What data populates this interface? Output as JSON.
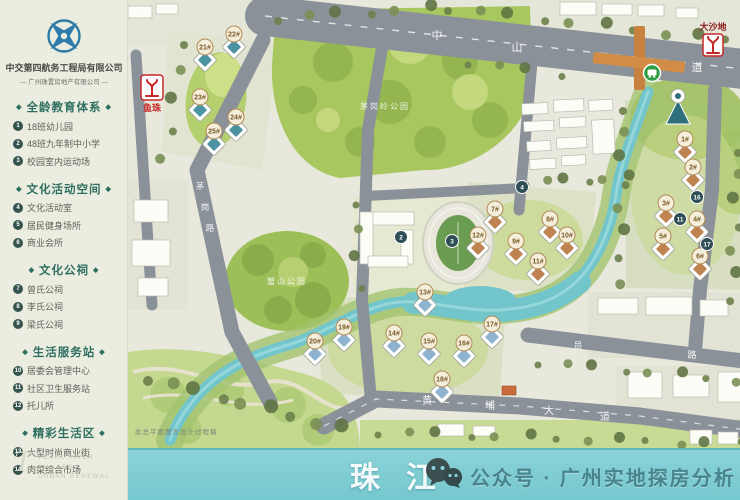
{
  "sidebar": {
    "company_line1": "中交第四航务工程局有限公司",
    "company_line2": "— 广州珠置房地产有限公司 —",
    "sections": [
      {
        "title": "全龄教育体系",
        "items": [
          {
            "num": "1",
            "label": "18班幼儿园"
          },
          {
            "num": "2",
            "label": "48班九年制中小学"
          },
          {
            "num": "3",
            "label": "校园室内运动场"
          }
        ]
      },
      {
        "title": "文化活动空间",
        "items": [
          {
            "num": "4",
            "label": "文化活动室"
          },
          {
            "num": "5",
            "label": "居民健身场所"
          },
          {
            "num": "6",
            "label": "商业会所"
          }
        ]
      },
      {
        "title": "文化公祠",
        "items": [
          {
            "num": "7",
            "label": "曾氏公祠"
          },
          {
            "num": "8",
            "label": "李氏公祠"
          },
          {
            "num": "9",
            "label": "梁氏公祠"
          }
        ]
      },
      {
        "title": "生活服务站",
        "items": [
          {
            "num": "10",
            "label": "居委会管理中心"
          },
          {
            "num": "11",
            "label": "社区卫生服务站"
          },
          {
            "num": "12",
            "label": "托儿所"
          }
        ]
      },
      {
        "title": "精彩生活区",
        "items": [
          {
            "num": "13",
            "label": "大型时尚商业街"
          },
          {
            "num": "14",
            "label": "肉菜综合市场"
          }
        ]
      }
    ],
    "footer_en_1": "PEARL RIVER VILLAGE",
    "footer_en_2": "URBAN RENEWAL"
  },
  "map": {
    "road_labels": [
      {
        "id": "zhongshan-avenue",
        "chars": [
          "中",
          "山",
          "大",
          "道"
        ]
      },
      {
        "id": "maogang-road",
        "chars": [
          "茅",
          "岗",
          "路"
        ]
      },
      {
        "id": "haiyuan-road",
        "chars": [
          "员",
          "路"
        ]
      },
      {
        "id": "huangpu-avenue",
        "chars": [
          "黄",
          "埔",
          "大",
          "道"
        ]
      }
    ],
    "metro_stations": [
      {
        "name": "鱼珠"
      },
      {
        "name": "大沙地"
      }
    ],
    "parks": [
      {
        "name": "茅岗岭公园"
      },
      {
        "name": "蟹山公园"
      }
    ],
    "disclaimer": "此总平面图为设计过程稿",
    "building_badges": {
      "upper_left": [
        "21#",
        "22#",
        "23#",
        "24#",
        "25#"
      ],
      "right": [
        "1#",
        "2#",
        "3#",
        "4#",
        "5#",
        "6#"
      ],
      "center": [
        "7#",
        "8#",
        "9#",
        "10#",
        "11#",
        "12#"
      ],
      "south": [
        "13#",
        "14#",
        "15#",
        "16#",
        "17#",
        "18#"
      ],
      "southwest": [
        "19#",
        "20#"
      ]
    },
    "facility_badges": [
      "2",
      "3",
      "4",
      "11",
      "16",
      "17"
    ],
    "colors": {
      "road": "#8b9199",
      "water": "#72c6cb",
      "park": "#a9c75f",
      "metro_red": "#c62828",
      "brt_green": "#2f9e44"
    }
  },
  "river_bar": {
    "river_chars": [
      "珠",
      "江"
    ],
    "watermark": "公众号 · 广州实地探房分析"
  }
}
